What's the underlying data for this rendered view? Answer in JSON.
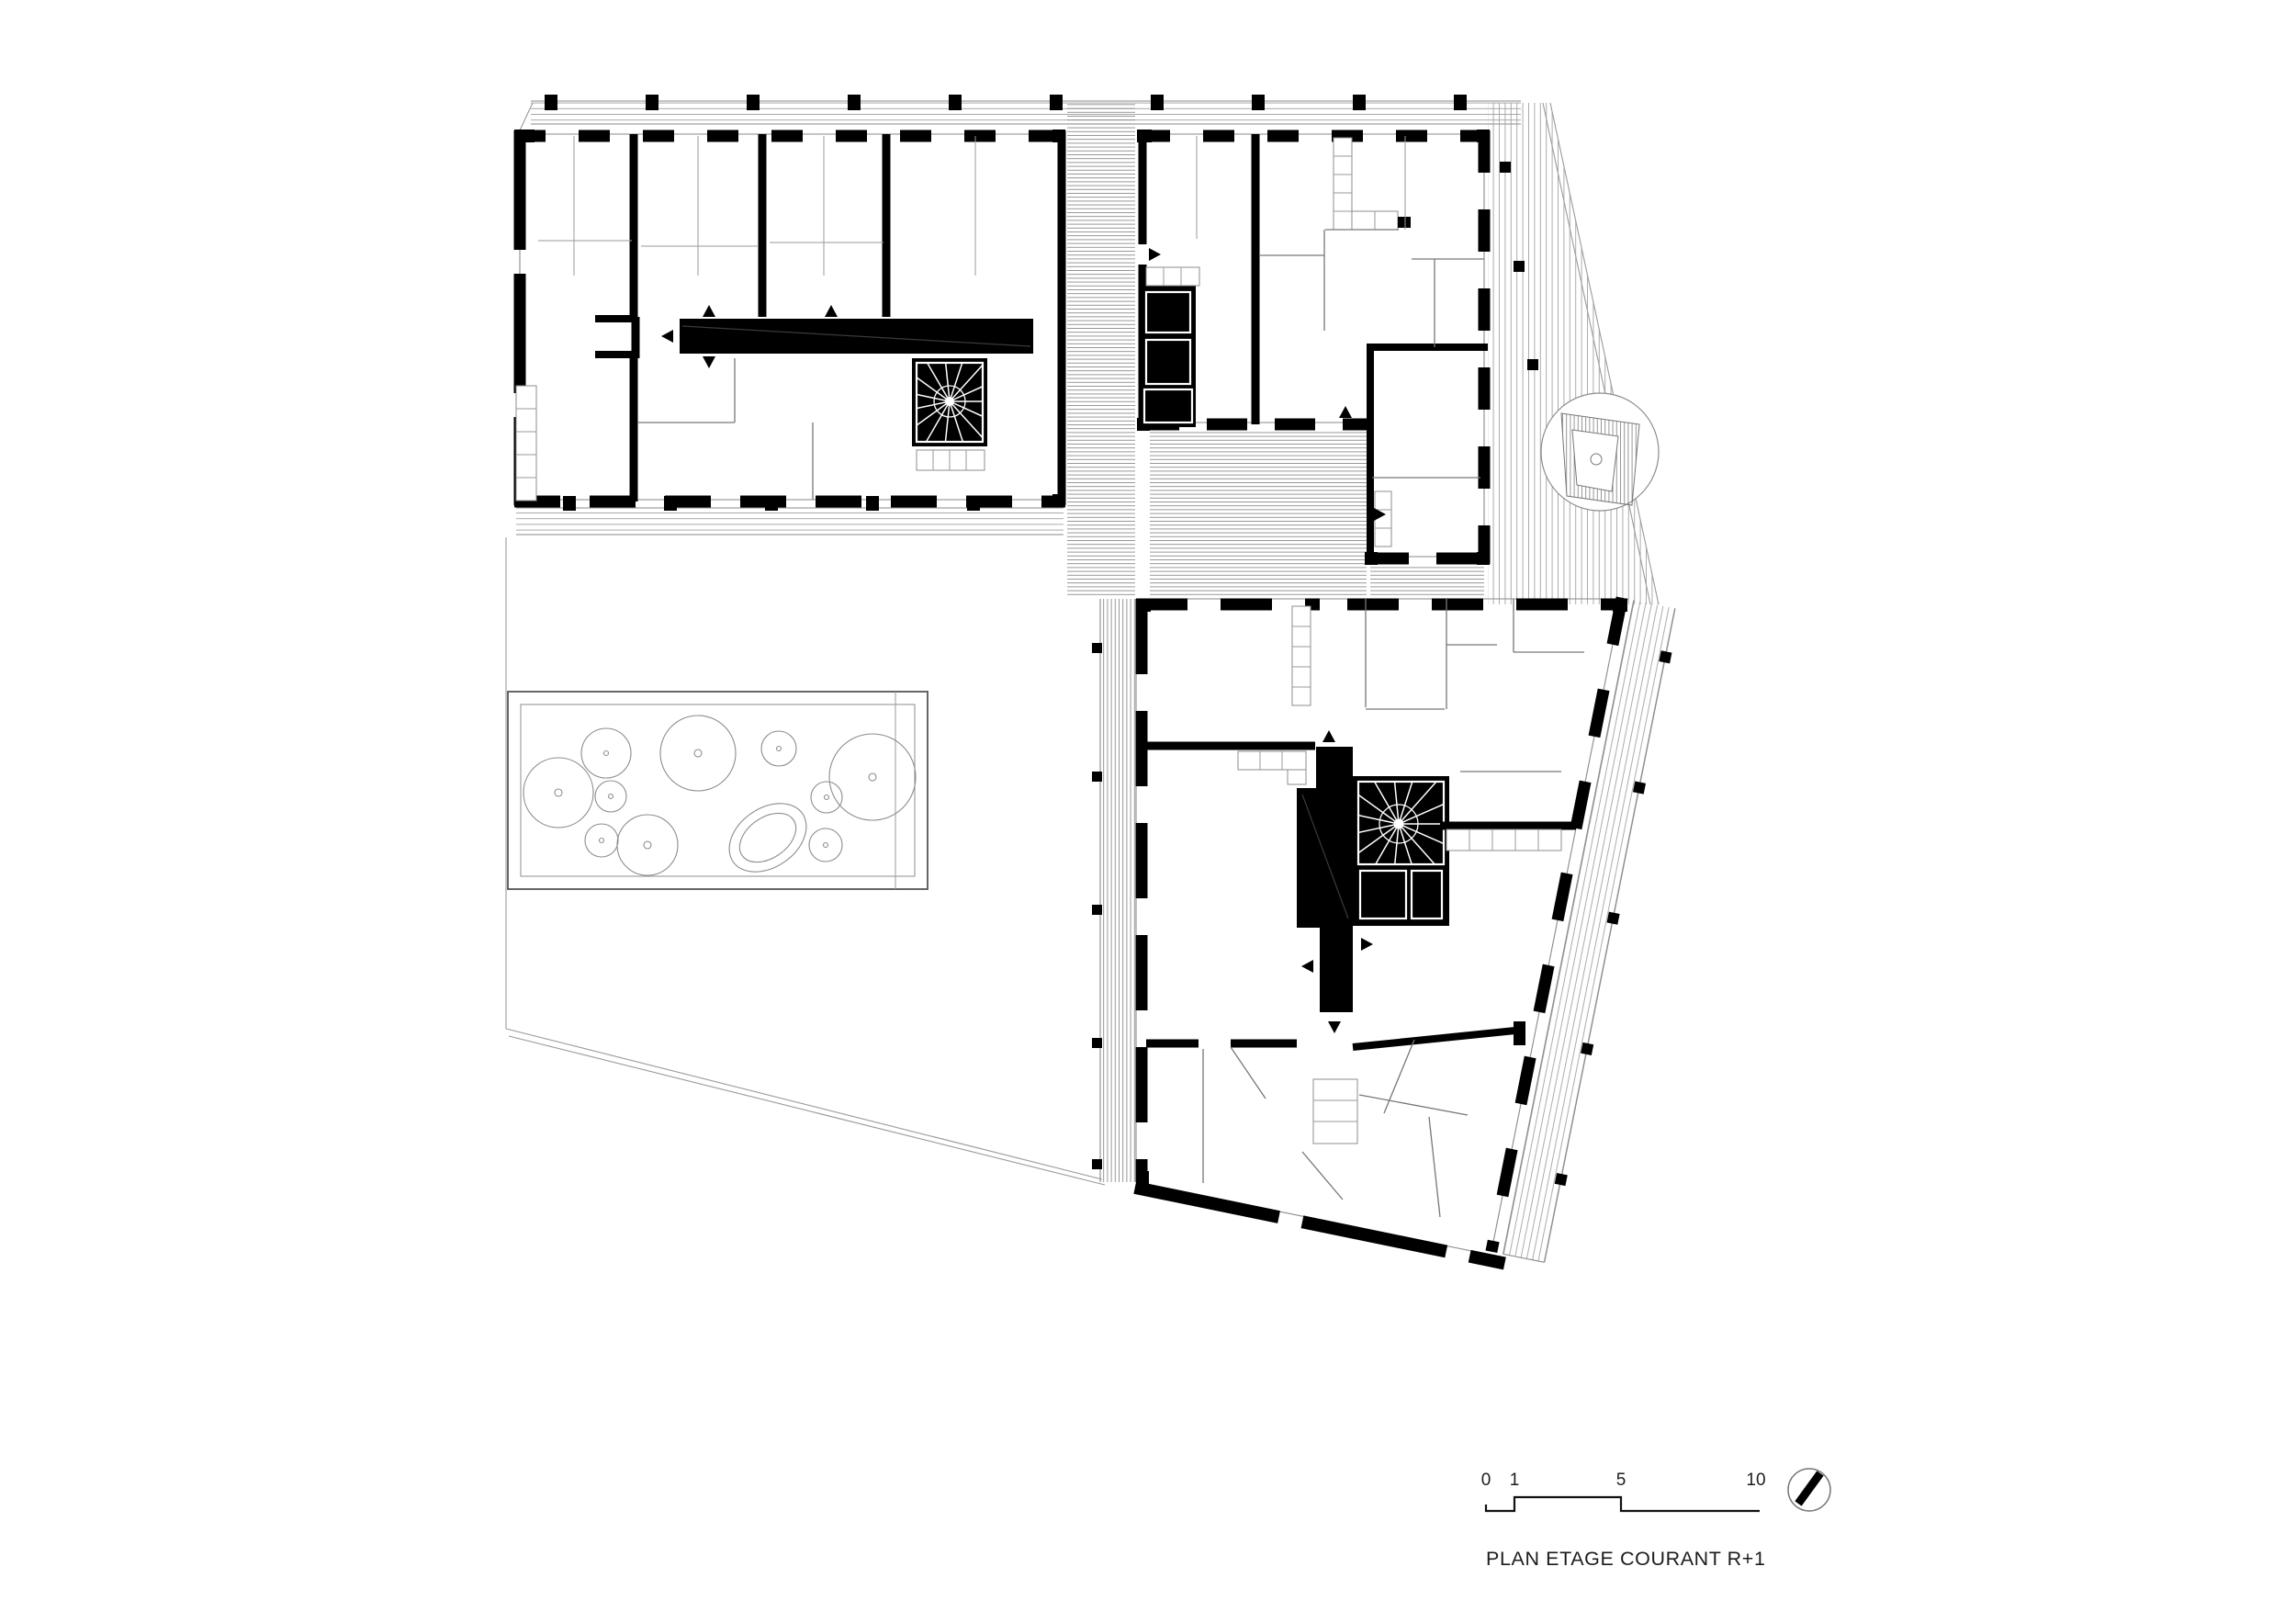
{
  "document": {
    "title": "PLAN ETAGE COURANT R+1"
  },
  "scale_bar": {
    "tick_0": "0",
    "tick_1": "1",
    "tick_5": "5",
    "tick_10": "10"
  },
  "icons": {
    "north_arrow": "north-arrow",
    "spiral_stair": "spiral-stair",
    "door_arrow": "door-direction-triangle"
  },
  "colors": {
    "ink": "#000000",
    "hatch": "#8c8c8c",
    "site_line": "#9a9a9a",
    "paper": "#ffffff"
  }
}
